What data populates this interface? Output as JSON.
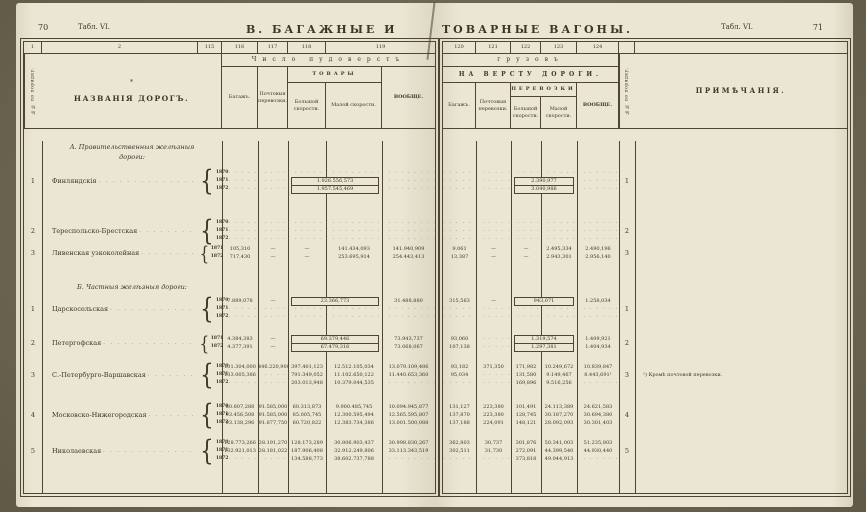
{
  "page_left": {
    "page_number": "70",
    "table_ref": "Табл. VI.",
    "title": "В. БАГАЖНЫЕ И",
    "col_numbers": [
      "1",
      "2",
      "115",
      "116",
      "117",
      "118",
      "119"
    ],
    "span_header": "Число пудоверстъ",
    "order_header": "№№ по порядку.",
    "names_star": "*",
    "names_header": "НАЗВАНІЯ ДОРОГЪ.",
    "col_baggage": "Багажъ.",
    "col_post": "Почтовыя перевозки.",
    "col_goods_group": "ТОВАРЫ",
    "col_fast": "Большой скорости.",
    "col_slow": "Малой скорости.",
    "col_total": "ВООБЩЕ."
  },
  "page_right": {
    "title": "ТОВАРНЫЕ ВАГОНЫ.",
    "table_ref": "Табл. VI.",
    "page_number": "71",
    "col_numbers": [
      "120",
      "121",
      "122",
      "123",
      "124"
    ],
    "span_header": "грузовъ",
    "per_verst_header": "НА ВЕРСТУ ДОРОГИ.",
    "col_baggage": "Багажъ.",
    "col_post": "Почтовыя перевозки.",
    "col_goods_group": "ПЕРЕВОЗКИ",
    "col_fast": "Большой скорости.",
    "col_slow": "Малой скорости.",
    "col_total": "ВООБЩЕ.",
    "order_header": "№№ по порядку.",
    "notes_header": "ПРИМѢЧАНІЯ."
  },
  "sections": [
    {
      "heading": "А. Правительственныя желѣзныя\nдороги:",
      "rows": [
        {
          "num": "1",
          "name": "Финляндскія",
          "years": [
            "1870",
            "1871",
            "1872"
          ],
          "left": [
            {
              "c": [
                "dots",
                "dots",
                "dots",
                "dots",
                "dots"
              ]
            },
            {
              "merge": true,
              "c": [
                "dots",
                "dots",
                "1.926.556,573",
                "dots"
              ]
            },
            {
              "merge": true,
              "c": [
                "dots",
                "dots",
                "1.957.545,469",
                "dots"
              ]
            }
          ],
          "right": [
            {
              "c": [
                "dots",
                "dots",
                "dots",
                "dots",
                "dots"
              ]
            },
            {
              "merge": true,
              "c": [
                "dots",
                "dots",
                "2.390,977",
                "dots"
              ]
            },
            {
              "merge": true,
              "c": [
                "dots",
                "dots",
                "3.040,986",
                "dots"
              ]
            }
          ],
          "note": ""
        },
        {
          "num": "2",
          "name": "Тереспольско-Брестская",
          "years": [
            "1870",
            "1871",
            "1872"
          ],
          "left": [
            {
              "c": [
                "dots",
                "dots",
                "dots",
                "dots",
                "dots"
              ]
            },
            {
              "c": [
                "dots",
                "dots",
                "dots",
                "dots",
                "dots"
              ]
            },
            {
              "c": [
                "dots",
                "dots",
                "dots",
                "dots",
                "dots"
              ]
            }
          ],
          "right": [
            {
              "c": [
                "dots",
                "dots",
                "dots",
                "dots",
                "dots"
              ]
            },
            {
              "c": [
                "dots",
                "dots",
                "dots",
                "dots",
                "dots"
              ]
            },
            {
              "c": [
                "dots",
                "dots",
                "dots",
                "dots",
                "dots"
              ]
            }
          ],
          "note": ""
        },
        {
          "num": "3",
          "name": "Ливенская узкоколейная",
          "years": [
            "1871",
            "1872"
          ],
          "left": [
            {
              "c": [
                "105,310",
                "—",
                "—",
                "141.434,093",
                "141.940,909"
              ]
            },
            {
              "c": [
                "717,430",
                "—",
                "—",
                "253.695,914",
                "254.443,413"
              ]
            }
          ],
          "right": [
            {
              "c": [
                "9,061",
                "—",
                "—",
                "2.495,334",
                "2.490,196"
              ]
            },
            {
              "c": [
                "13,387",
                "—",
                "—",
                "2.943,301",
                "2.956,140"
              ]
            }
          ],
          "note": ""
        }
      ]
    },
    {
      "heading": "Б. Частныя желѣзныя дороги:",
      "rows": [
        {
          "num": "1",
          "name": "Царскосельская",
          "years": [
            "1870",
            "1871",
            "1872"
          ],
          "left": [
            {
              "merge": true,
              "c": [
                "7.889,078",
                "—",
                "23.366,773",
                "31.488,880"
              ]
            },
            {
              "c": [
                "dots",
                "dots",
                "dots",
                "dots",
                "dots"
              ]
            },
            {
              "c": [
                "dots",
                "dots",
                "dots",
                "dots",
                "dots"
              ]
            }
          ],
          "right": [
            {
              "merge": true,
              "c": [
                "315,563",
                "—",
                "943,071",
                "1.258,034"
              ]
            },
            {
              "c": [
                "dots",
                "dots",
                "dots",
                "dots",
                "dots"
              ]
            },
            {
              "c": [
                "dots",
                "dots",
                "dots",
                "dots",
                "dots"
              ]
            }
          ],
          "note": ""
        },
        {
          "num": "2",
          "name": "Петергофская",
          "years": [
            "1871",
            "1872"
          ],
          "left": [
            {
              "merge": true,
              "c": [
                "4.384,383",
                "—",
                "69.379,446",
                "73.943,737"
              ]
            },
            {
              "merge": true,
              "c": [
                "4.377,391",
                "—",
                "67.479,316",
                "73.068,067"
              ]
            }
          ],
          "right": [
            {
              "merge": true,
              "c": [
                "93,060",
                "dots",
                "1.319,574",
                "1.409,921"
              ]
            },
            {
              "merge": true,
              "c": [
                "107,138",
                "dots",
                "1.297,381",
                "1.404,934"
              ]
            }
          ],
          "note": ""
        },
        {
          "num": "3",
          "name": "С.-Петербурго-Варшавская",
          "years": [
            "1870",
            "1871",
            "1872"
          ],
          "left": [
            {
              "c": [
                "131.304,000",
                "446.220,900",
                "397.401,123",
                "12.512.105,034",
                "13.079.109,486"
              ]
            },
            {
              "c": [
                "133.005,386",
                "dots",
                "791.349,052",
                "11.102.650,122",
                "11.440.653,360"
              ]
            },
            {
              "c": [
                "dots",
                "dots",
                "203.013,948",
                "10.379.044,535",
                "dots"
              ]
            }
          ],
          "right": [
            {
              "c": [
                "93,182",
                "371,350",
                "171,982",
                "10.249,672",
                "10.839,847"
              ]
            },
            {
              "c": [
                "95,034",
                "dots",
                "131,580",
                "9.149,467",
                "8.443,691¹"
              ]
            },
            {
              "c": [
                "dots",
                "dots",
                "169,896",
                "9.516,256",
                "dots"
              ]
            }
          ],
          "note": "¹) Кромѣ почтовой перевозки."
        },
        {
          "num": "4",
          "name": "Московско-Нижегородская",
          "years": [
            "1870",
            "1871",
            "1872"
          ],
          "left": [
            {
              "c": [
                "80.807,288",
                "91.585,000",
                "60.313,873",
                "9.900.485,745",
                "10.094.945,877"
              ]
            },
            {
              "c": [
                "93.456,508",
                "91.585,000",
                "85.005,745",
                "12.300.595,494",
                "12.565.595,807"
              ]
            },
            {
              "c": [
                "93.138,296",
                "91.877,750",
                "60.720,822",
                "12.383.734,386",
                "13.001.500,088"
              ]
            }
          ],
          "right": [
            {
              "c": [
                "131,127",
                "223,380",
                "101,491",
                "24.113,389",
                "24.621,583"
              ]
            },
            {
              "c": [
                "137,870",
                "223,380",
                "128,745",
                "30.187,270",
                "30.694,380"
              ]
            },
            {
              "c": [
                "137,188",
                "224,091",
                "148,121",
                "28.092,093",
                "30.301,403"
              ]
            }
          ],
          "note": ""
        },
        {
          "num": "5",
          "name": "Николаевская",
          "years": [
            "1870",
            "1871",
            "1872"
          ],
          "left": [
            {
              "c": [
                "128.773,266",
                "28.191,270",
                "128.173,289",
                "30.806.903,437",
                "30.998.830,267"
              ]
            },
            {
              "c": [
                "132.921,013",
                "28.181,022",
                "187.906,408",
                "32.912.249,806",
                "33.113.343,519"
              ]
            },
            {
              "c": [
                "dots",
                "dots",
                "134.588,773",
                "38.602.737,788",
                "dots"
              ]
            }
          ],
          "right": [
            {
              "c": [
                "362,803",
                "30,737",
                "301,876",
                "50.341,003",
                "51.235,803"
              ]
            },
            {
              "c": [
                "302,511",
                "31,730",
                "272,091",
                "44.399,540",
                "44.930,440"
              ]
            },
            {
              "c": [
                "dots",
                "dots",
                "373,818",
                "49.044,913",
                "dots"
              ]
            }
          ],
          "note": ""
        }
      ]
    }
  ]
}
